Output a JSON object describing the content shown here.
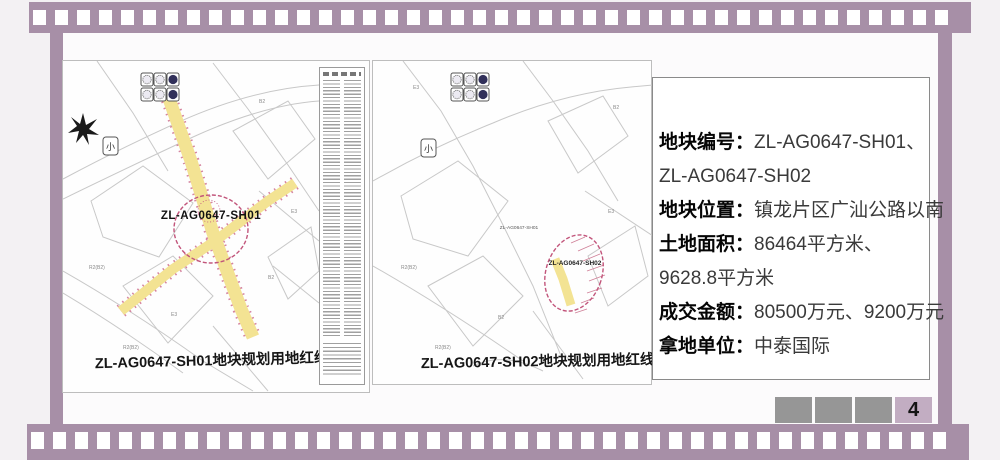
{
  "slide": {
    "type": "land-transaction-slide",
    "colors": {
      "film_strip": "#a78fa7",
      "background": "#f3f1f3",
      "pager_box": "#969696",
      "pager_current_bg": "#c2adc2",
      "road_highlight_yellow": "#f3e393",
      "red_line": "#c2557b"
    }
  },
  "maps": [
    {
      "parcel_label": "ZL-AG0647-SH01",
      "caption": "ZL-AG0647-SH01地块规划用地红线图",
      "small_icon": "小",
      "zone_labels": [
        "R2(B2)",
        "R2(B2)",
        "B2",
        "E3",
        "B2",
        "E3"
      ]
    },
    {
      "parcel_label": "ZL-AG0647-SH02",
      "neighbor_label": "ZL-AG0647-SH01",
      "caption": "ZL-AG0647-SH02地块规划用地红线图",
      "small_icon": "小",
      "zone_labels": [
        "R2(B2)",
        "R2(B2)",
        "B2",
        "E3",
        "B2",
        "E3"
      ]
    }
  ],
  "info_panel": {
    "lines": [
      {
        "label": "地块编号：",
        "value": "ZL-AG0647-SH01、"
      },
      {
        "label": "",
        "value": "ZL-AG0647-SH02"
      },
      {
        "label": "地块位置：",
        "value": "镇龙片区广汕公路以南"
      },
      {
        "label": "土地面积：",
        "value": "86464平方米、"
      },
      {
        "label": "",
        "value": "9628.8平方米"
      },
      {
        "label": "成交金额：",
        "value": "80500万元、9200万元"
      },
      {
        "label": "拿地单位：",
        "value": "中泰国际"
      }
    ]
  },
  "pager": {
    "page_number": "4"
  }
}
